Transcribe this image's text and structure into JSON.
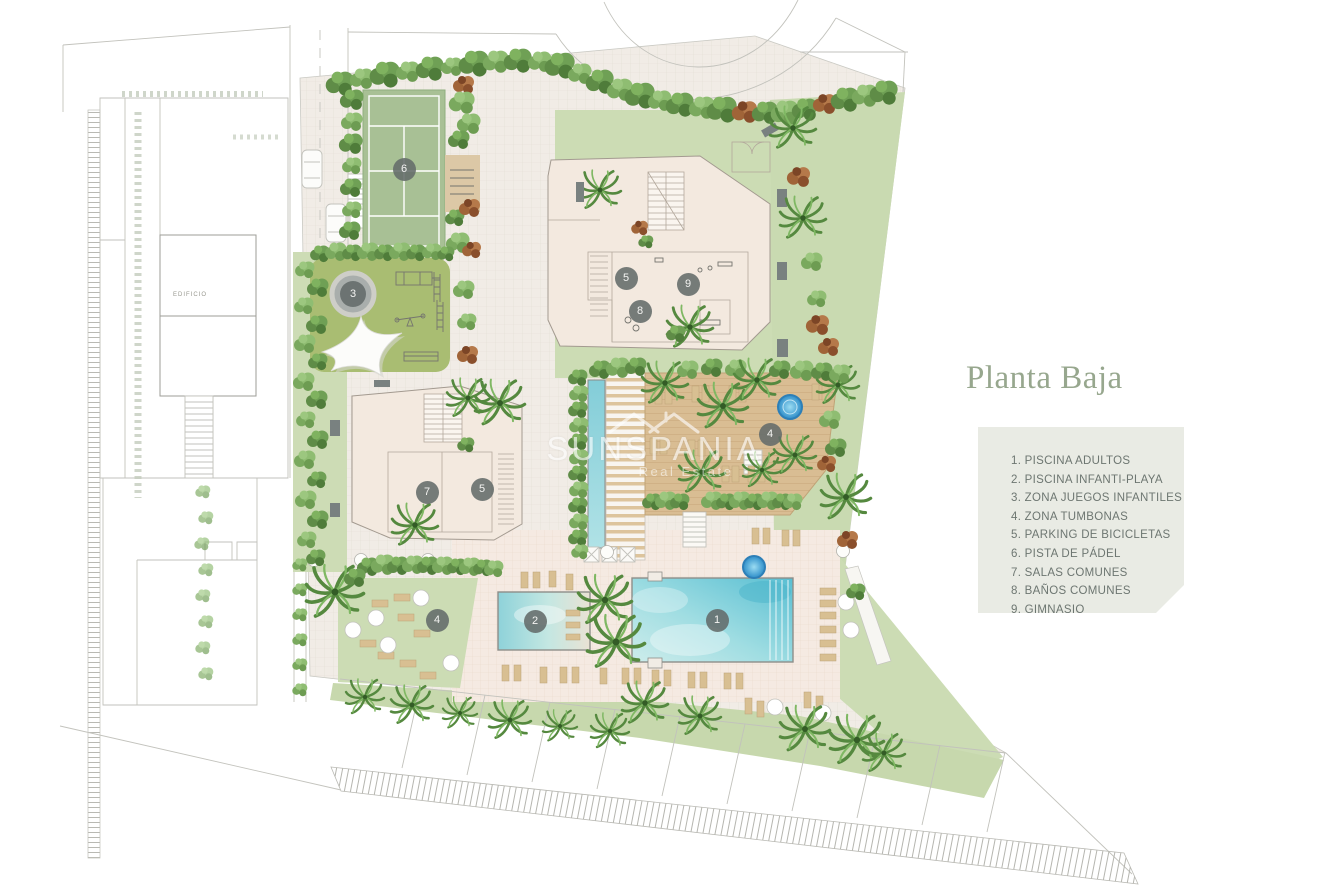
{
  "title": "Planta Baja",
  "legend": {
    "items": [
      "1. PISCINA ADULTOS",
      "2. PISCINA INFANTI-PLAYA",
      "3. ZONA JUEGOS INFANTILES",
      "4. ZONA TUMBONAS",
      "5. PARKING DE BICICLETAS",
      "6. PISTA DE PÁDEL",
      "7. SALAS COMUNES",
      "8. BAÑOS COMUNES",
      "9. GIMNASIO"
    ]
  },
  "watermark": {
    "brand": "SUNSPANIA",
    "tagline": "Real Estate"
  },
  "plan": {
    "neighbor_building_label": "EDIFICIO"
  },
  "badges": [
    {
      "num": "6",
      "area": "pista-de-padel"
    },
    {
      "num": "3",
      "area": "zona-juegos-infantiles"
    },
    {
      "num": "5",
      "area": "parking-bicicletas-bloque-2"
    },
    {
      "num": "9",
      "area": "gimnasio"
    },
    {
      "num": "8",
      "area": "banos-comunes"
    },
    {
      "num": "7",
      "area": "salas-comunes"
    },
    {
      "num": "5",
      "area": "parking-bicicletas-bloque-1"
    },
    {
      "num": "4",
      "area": "zona-tumbonas-deck"
    },
    {
      "num": "4",
      "area": "zona-tumbonas-cesped"
    },
    {
      "num": "2",
      "area": "piscina-infantil-playa"
    },
    {
      "num": "1",
      "area": "piscina-adultos"
    }
  ],
  "colors": {
    "title_green": "#97a78e",
    "legend_bg": "#e9ebe4",
    "legend_text": "#6d7671",
    "lawn": "#cddcb5",
    "playground_green": "#a9bd72",
    "padel_green": "#a8c095",
    "paving": "#f1ece6",
    "deck_wood": "#d9bd93",
    "pool_water": "#58bed2",
    "jacuzzi_blue": "#2e8ec9",
    "badge_gray": "#636b6a"
  }
}
